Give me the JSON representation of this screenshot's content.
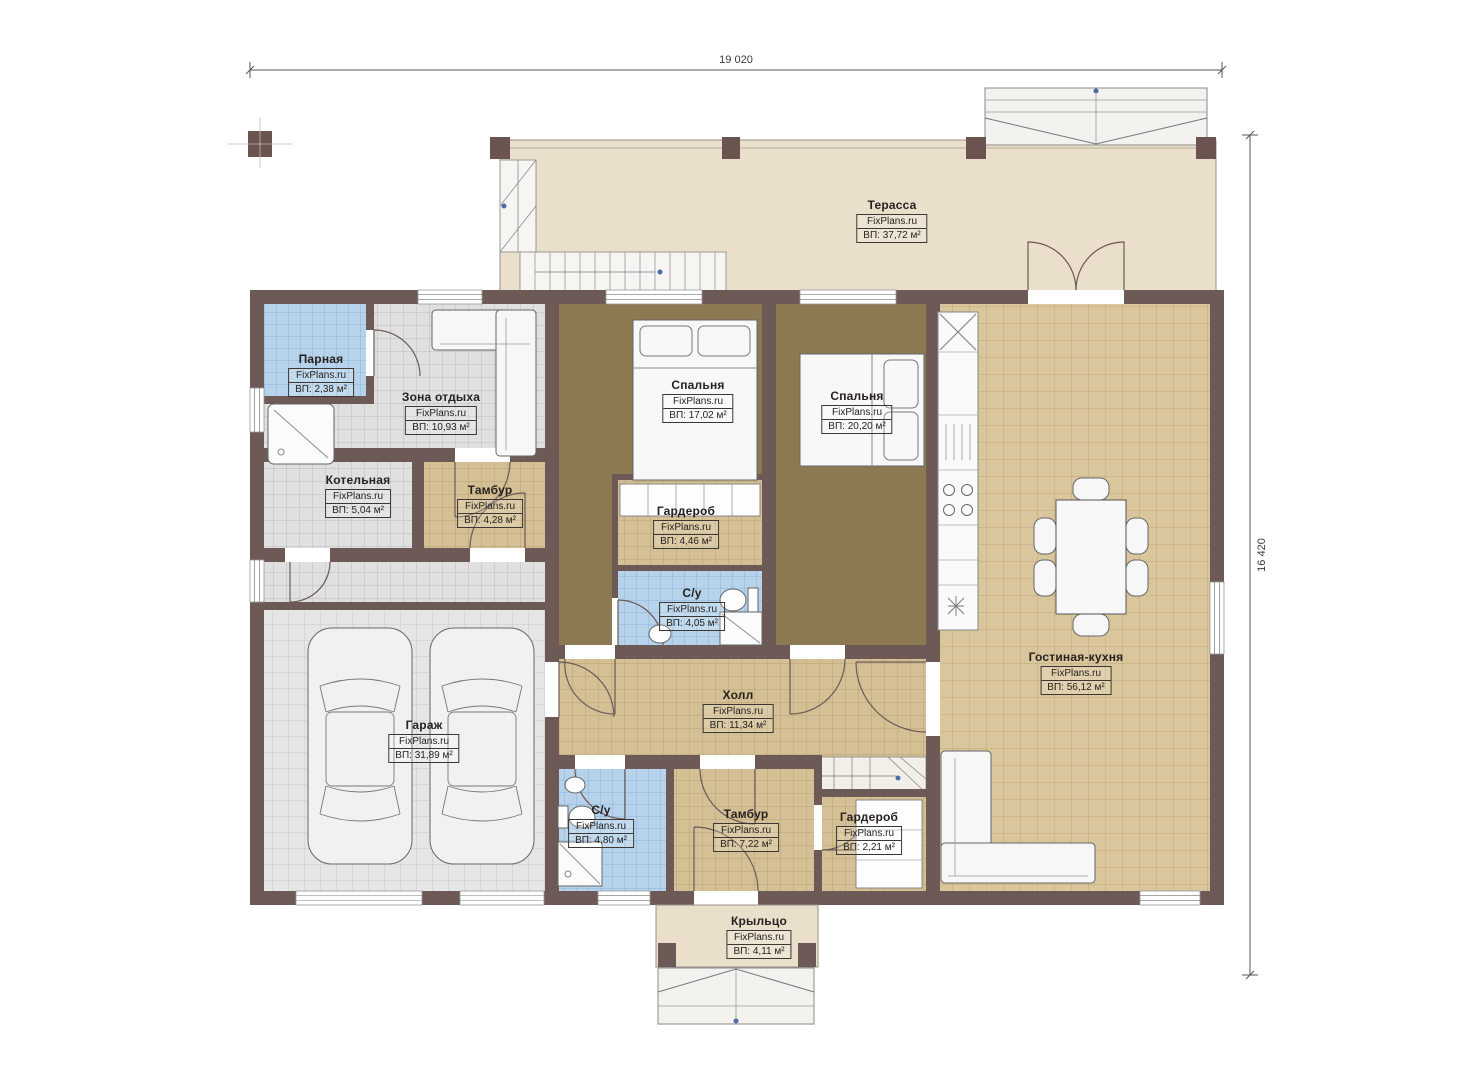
{
  "watermark": "FixPlans.ru",
  "dimensions": {
    "width": "19 020",
    "height": "16 420"
  },
  "colors": {
    "wall": "#6d5a57",
    "terrace_floor": "#e9dfcb",
    "tan_tile": "#d9c69c",
    "tan_tile_small": "#d4c094",
    "gray_tile": "#e0e0e0",
    "garage_tile": "#e6e6e6",
    "blue_tile": "#b6d3eb",
    "bedroom_floor": "#8c7851"
  },
  "rooms": [
    {
      "name": "Терасса",
      "area": "ВП: 37,72 м²"
    },
    {
      "name": "Парная",
      "area": "ВП: 2,38 м²"
    },
    {
      "name": "Зона отдыха",
      "area": "ВП: 10,93 м²"
    },
    {
      "name": "Котельная",
      "area": "ВП: 5,04 м²"
    },
    {
      "name": "Тамбур",
      "area": "ВП: 4,28 м²"
    },
    {
      "name": "Спальня",
      "area": "ВП: 17,02 м²"
    },
    {
      "name": "Спальня",
      "area": "ВП: 20,20 м²"
    },
    {
      "name": "Гардероб",
      "area": "ВП: 4,46 м²"
    },
    {
      "name": "С/у",
      "area": "ВП: 4,05 м²"
    },
    {
      "name": "Гараж",
      "area": "ВП: 31,89 м²"
    },
    {
      "name": "Холл",
      "area": "ВП: 11,34 м²"
    },
    {
      "name": "С/у",
      "area": "ВП: 4,80 м²"
    },
    {
      "name": "Тамбур",
      "area": "ВП: 7,22 м²"
    },
    {
      "name": "Гардероб",
      "area": "ВП: 2,21 м²"
    },
    {
      "name": "Гостиная-кухня",
      "area": "ВП: 56,12 м²"
    },
    {
      "name": "Крыльцо",
      "area": "ВП: 4,11 м²"
    }
  ]
}
